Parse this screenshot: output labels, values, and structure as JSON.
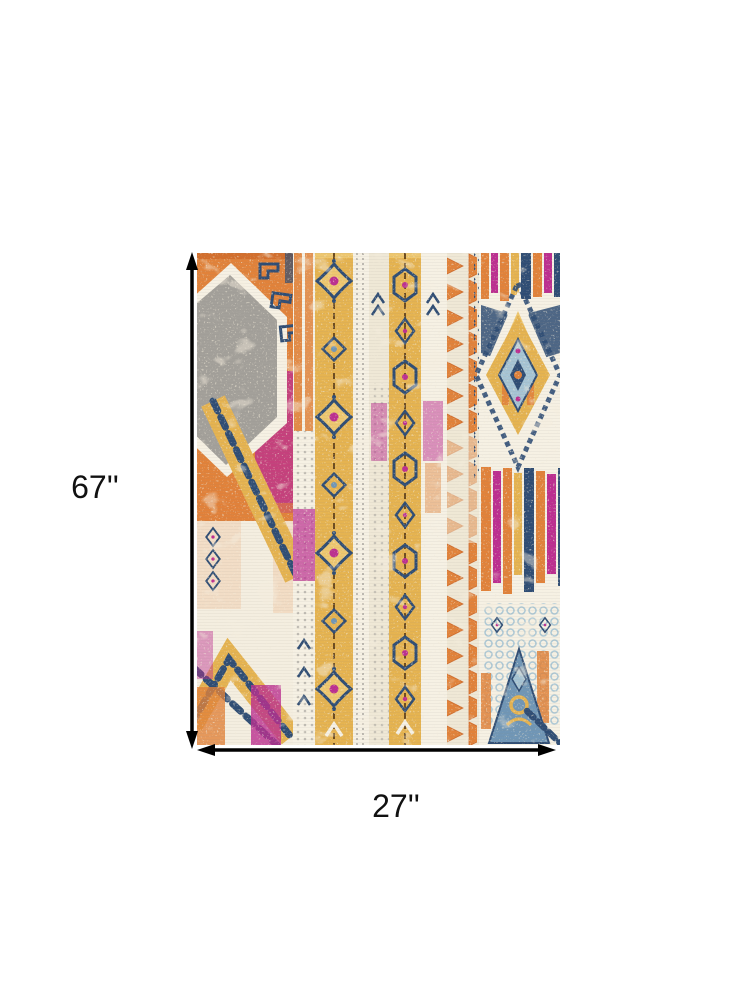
{
  "diagram": {
    "height_label": "67''",
    "width_label": "27''"
  },
  "icons": {
    "height_arrow": "double-headed-vertical-arrow-icon",
    "width_arrow": "double-headed-horizontal-arrow-icon"
  },
  "palette": {
    "background": "#ffffff",
    "dimension": "#000000",
    "label_text": "#111111",
    "rug_cream": "#efe8d6",
    "rug_cream_light": "#f6f1e4",
    "rug_orange": "#e1823a",
    "rug_rust": "#cf6a2b",
    "rug_gold": "#e5b350",
    "rug_gold_light": "#eec76f",
    "rug_magenta": "#bc2e90",
    "rug_pink": "#e387b9",
    "rug_navy": "#2f4d74",
    "rug_lightblue": "#a6c4d4",
    "rug_steelblue": "#7096b6",
    "rug_gray": "#a3a09a",
    "rug_gray_light": "#bdb9b1",
    "rug_brown": "#6d4c20"
  }
}
